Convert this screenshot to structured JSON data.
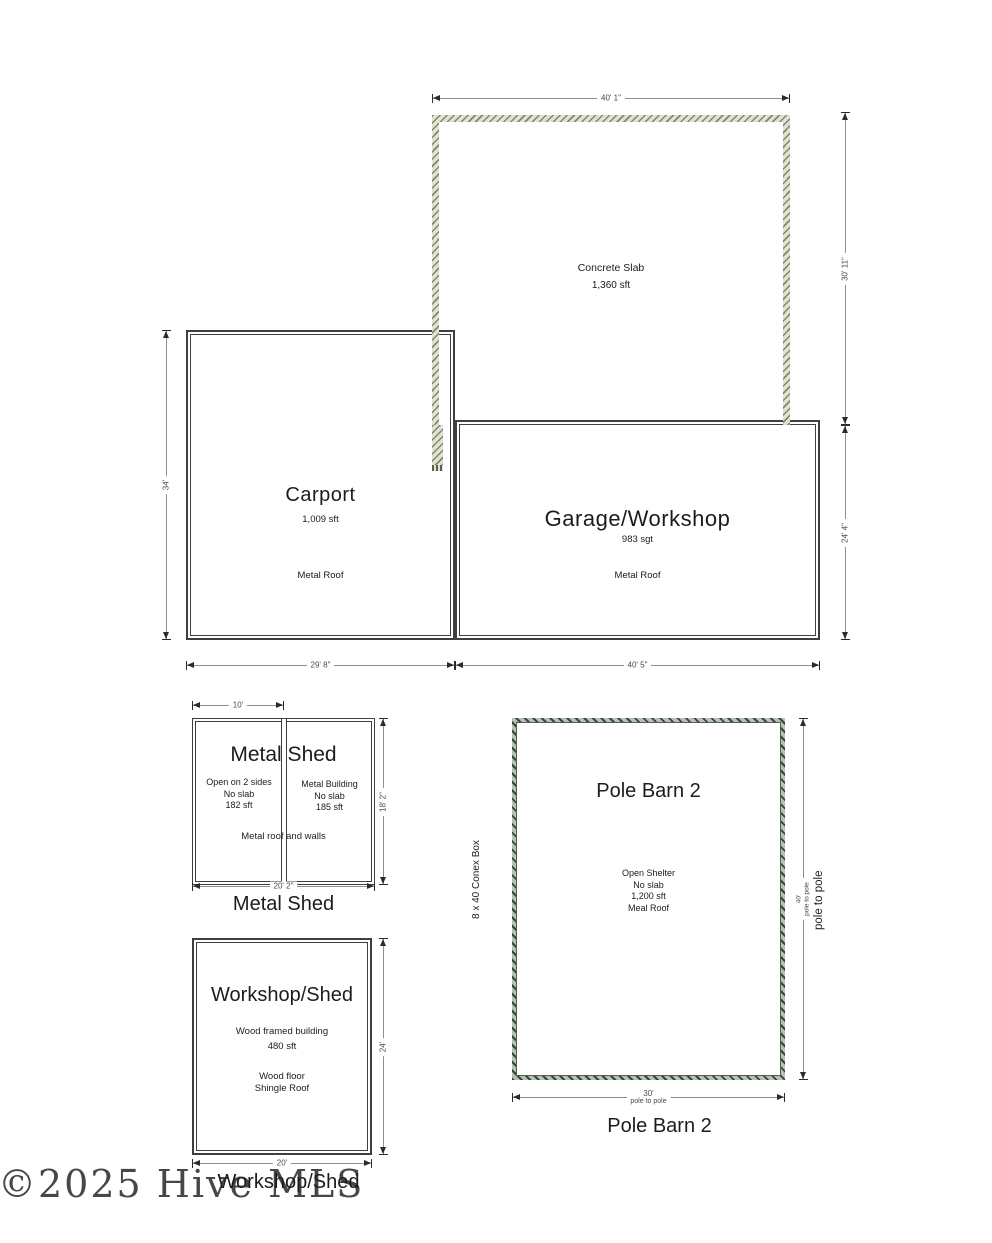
{
  "colors": {
    "wall": "#3f3f3f",
    "dim_line": "#8f8f8f",
    "dim_text": "#4a4a4a",
    "text": "#1c1c1c",
    "slab_band": "#e2e2d2",
    "slab_tick": "#85856f",
    "pole_band": "#b7bfb7",
    "pole_green": "#2d4d2d"
  },
  "watermark": {
    "text": "©2025 Hive MLS"
  },
  "slab": {
    "title": "Concrete Slab",
    "area": "1,360 sft",
    "dim_width": "40' 1\"",
    "dim_height": "30' 11\""
  },
  "carport": {
    "title": "Carport",
    "area": "1,009 sft",
    "roof": "Metal Roof",
    "dim_height": "34'",
    "dim_width": "29' 8\""
  },
  "garage": {
    "title": "Garage/Workshop",
    "area": "983 sgt",
    "roof": "Metal Roof",
    "dim_height": "24' 4\"",
    "dim_width": "40' 5\""
  },
  "metal_shed": {
    "title": "Metal Shed",
    "caption": "Metal Shed",
    "left_unit": {
      "l1": "Open on 2 sides",
      "l2": "No slab",
      "l3": "182  sft"
    },
    "right_unit": {
      "l1": "Metal Building",
      "l2": "No slab",
      "l3": "185 sft"
    },
    "note": "Metal roof and walls",
    "dim_top": "10'",
    "dim_right": "18' 2\"",
    "dim_bottom": "20' 2\""
  },
  "workshop_shed": {
    "title": "Workshop/Shed",
    "caption": "Workshop/Shed",
    "l1": "Wood framed building",
    "l2": "480 sft",
    "l3": "Wood floor",
    "l4": "Shingle Roof",
    "dim_right": "24'",
    "dim_bottom": "20'"
  },
  "pole_barn": {
    "title": "Pole Barn 2",
    "caption": "Pole Barn 2",
    "l1": "Open Shelter",
    "l2": "No slab",
    "l3": "1,200 sft",
    "l4": "Meal Roof",
    "conex_label": "8 x 40 Conex Box",
    "dim_right_value": "40'",
    "dim_right_sub": "pole to pole",
    "right_side_label": "pole to pole",
    "dim_bottom_value": "30'",
    "dim_bottom_sub": "pole to pole"
  }
}
